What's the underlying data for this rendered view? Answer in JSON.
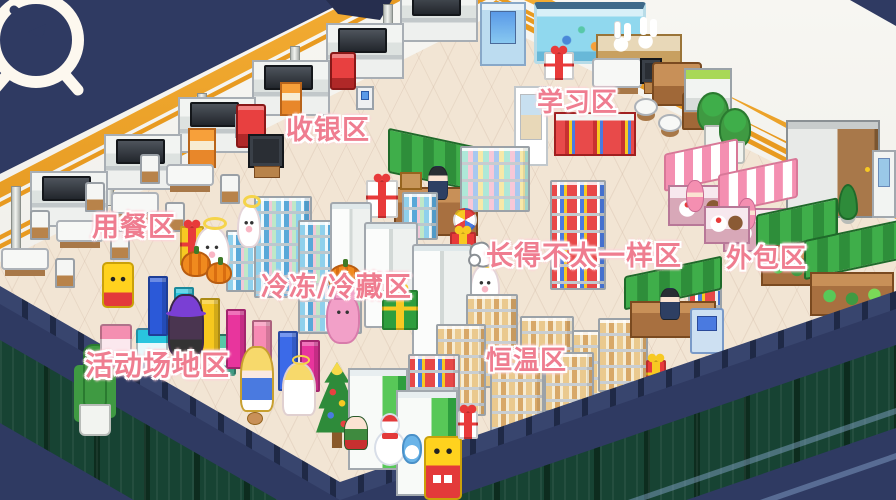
{
  "zones": {
    "cashier": {
      "label": "收银区"
    },
    "study": {
      "label": "学习区"
    },
    "dining": {
      "label": "用餐区"
    },
    "frozen": {
      "label": "冷冻/冷藏区"
    },
    "different": {
      "label": "长得不太一样区"
    },
    "outsourced": {
      "label": "外包区"
    },
    "activity": {
      "label": "活动场地区"
    },
    "thermostat": {
      "label": "恒温区"
    }
  },
  "hud": {
    "clock_icon": "alarm-clock-forward"
  },
  "cursor": {
    "icon": "hand-cursor"
  },
  "palette": {
    "label_pink": "#ef7d90",
    "label_outline": "#ffffff",
    "wall_trim_gold": "#e89a20",
    "roof_navy": "#2f3a62",
    "floor_cream": "#f2e5d4",
    "fence_green": "#174333",
    "stall_green": "#3fae4a",
    "stall_pink": "#f48fb1"
  },
  "sprites": [
    "cashier-counter-row",
    "dining-tables",
    "tv-set",
    "aquarium",
    "rabbit-statue-bench",
    "study-sofa",
    "poster-stand",
    "wall-book-shelf",
    "potted-plants",
    "storage-cabinet",
    "cake-stalls",
    "vegetable-stalls",
    "green-kiosk",
    "drink-shelves",
    "freezer-units",
    "bread-vending-machines",
    "atm-machine",
    "arcade-machines",
    "color-panels",
    "christmas-tree",
    "snowman",
    "angel-girl",
    "ghost-spirits",
    "pink-bunny",
    "witch",
    "yellow-mascots",
    "blonde-girl",
    "gift-boxes",
    "pumpkins",
    "cactus-pot",
    "hand-cursor"
  ]
}
